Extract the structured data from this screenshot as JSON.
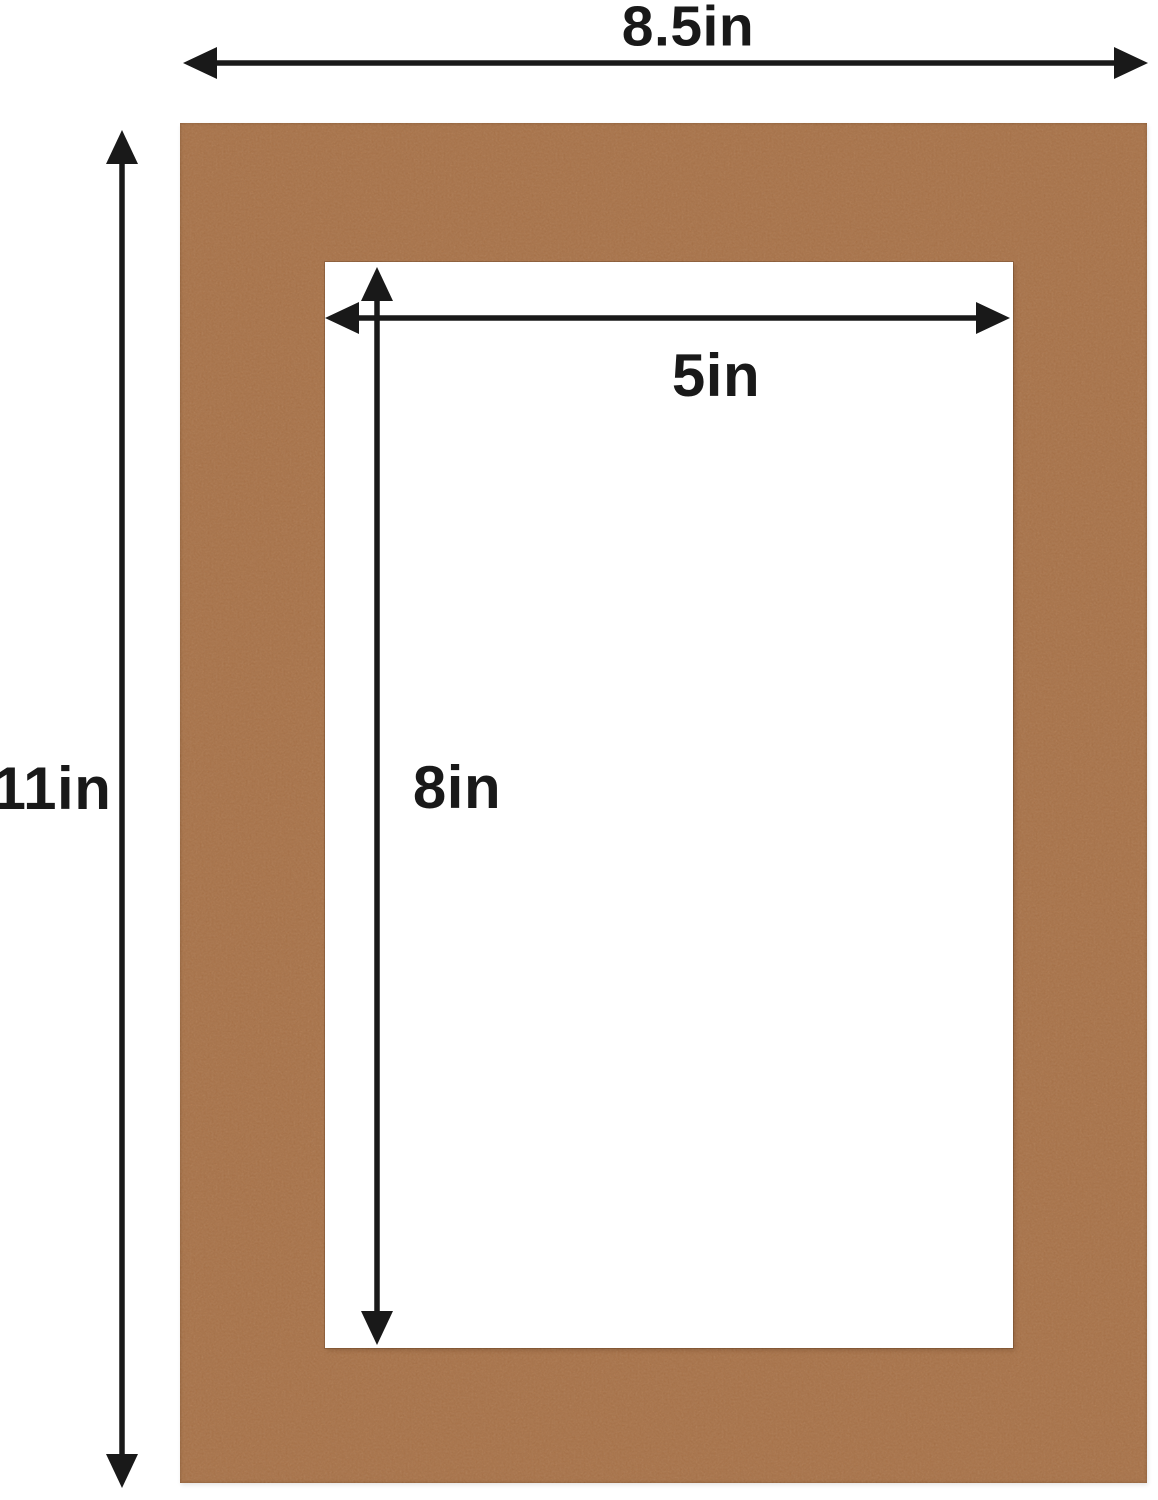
{
  "mat_diagram": {
    "outer": {
      "width_label": "8.5in",
      "height_label": "11in"
    },
    "opening": {
      "width_label": "5in",
      "height_label": "8in"
    },
    "colors": {
      "mat_brown": "#b77c4e",
      "arrow_black": "#191919",
      "background": "#ffffff"
    }
  }
}
